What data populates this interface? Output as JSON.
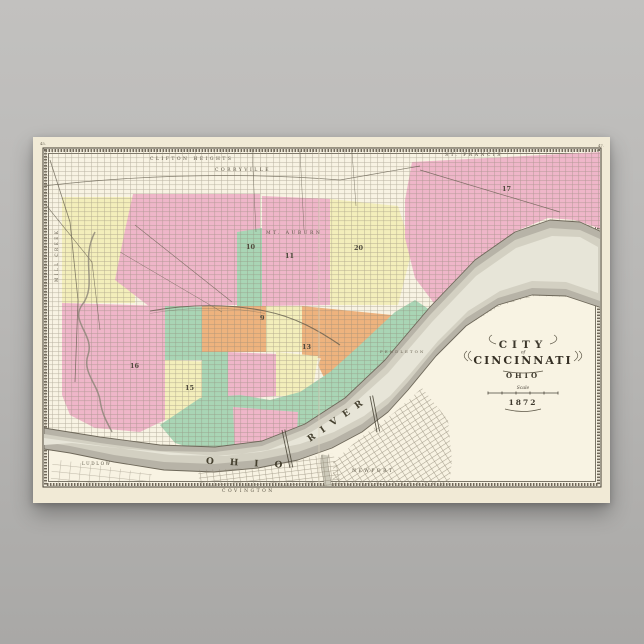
{
  "scene": {
    "background_top": "#c2c1bf",
    "background_bottom": "#a9a8a6",
    "description": "Vintage 1872 map of the City of Cincinnati, Ohio, printed on a cream poster shown against a gray wall"
  },
  "poster": {
    "paper_color": "#f1ead6",
    "map_paper_color": "#f8f3e3",
    "border_ink": "#453f33",
    "page_number_left": "45.",
    "page_number_right": "47."
  },
  "map": {
    "cartouche": {
      "city": "CITY",
      "of": "of",
      "name": "CINCINNATI",
      "state": "OHIO",
      "scale_label": "Scale",
      "year": "1872"
    },
    "labels": {
      "clifton_heights": "CLIFTON HEIGHTS",
      "corryville": "CORRYVILLE",
      "mt_auburn": "MT. AUBURN",
      "st_francis": "ST. FRANCIS",
      "pendleton": "PENDLETON",
      "mill_creek": "MILL CREEK",
      "ohio": "OHIO",
      "river": "RIVER",
      "ludlow": "LUDLOW",
      "covington": "COVINGTON",
      "newport": "NEWPORT"
    },
    "wards": [
      {
        "n": "16"
      },
      {
        "n": "15"
      },
      {
        "n": "10"
      },
      {
        "n": "11"
      },
      {
        "n": "20"
      },
      {
        "n": "17"
      },
      {
        "n": "9"
      },
      {
        "n": "13"
      }
    ],
    "palette": {
      "pink": "#efb6c9",
      "yellow": "#f3eebb",
      "green": "#a9d5b5",
      "orange": "#eeb37e",
      "river": "#b7b3a7",
      "river_core": "#e7e5d8",
      "ink": "#5c5646"
    }
  }
}
